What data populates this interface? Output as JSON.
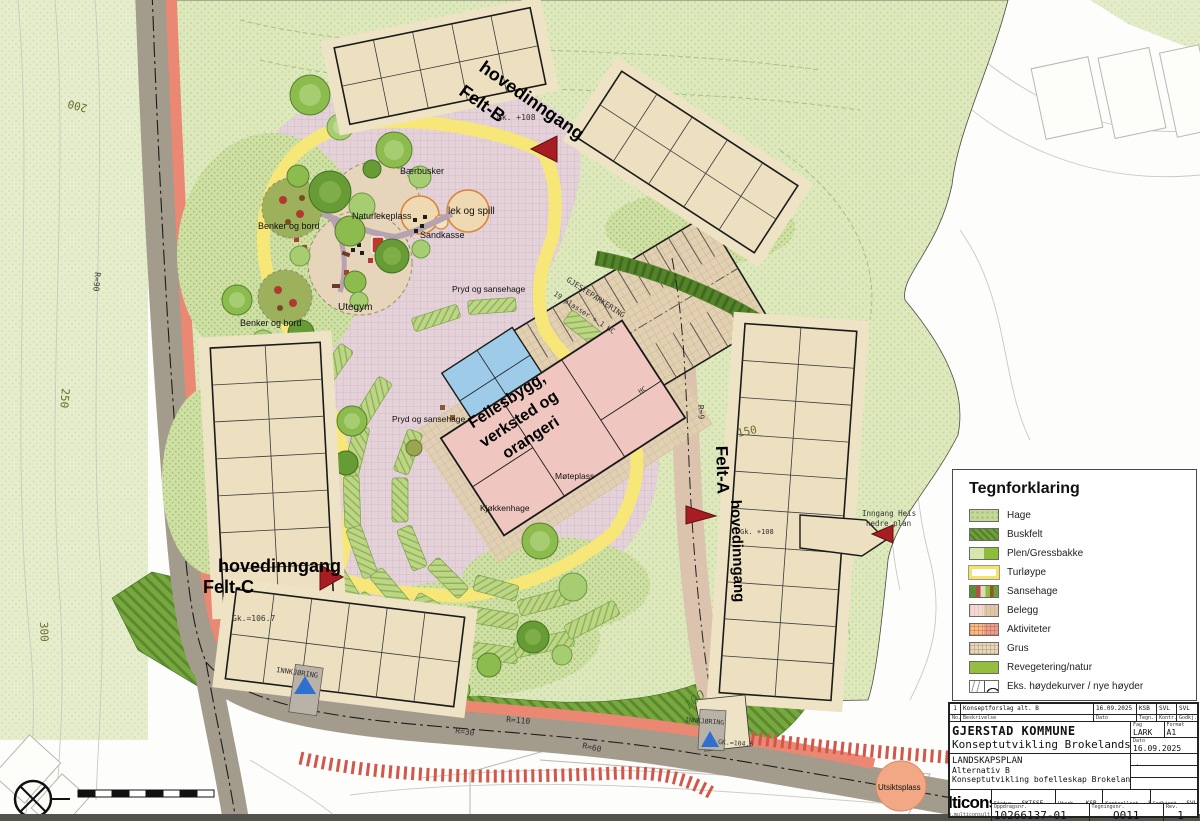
{
  "map": {
    "labels": {
      "feltB_line1": "hovedinngang",
      "feltB_line2": "Felt-B",
      "feltB_gk": "Gk. +108",
      "feltA_line1": "Felt-A",
      "feltA_line2": "hovedinngang",
      "feltA_gk": "Gk. +108",
      "feltC_line1": "hovedinngang",
      "feltC_line2": "Felt-C",
      "feltC_gk": "Gk.=106.7",
      "heis_line1": "Inngang Heis",
      "heis_line2": "nedre plan",
      "fellesbygg_line1": "Fellesbygg,",
      "fellesbygg_line2": "verksted og",
      "fellesbygg_line3": "orangeri",
      "gjesteparkering_line1": "GJESTEPARKERING",
      "gjesteparkering_line2": "19 plasser + 1 HC",
      "innkjoring_c": "INNKJØRING",
      "innkjoring_a": "INNKJØRING",
      "gk_a": "GK.=104.6",
      "baerbusker": "Bærbusker",
      "naturlekeplass": "Naturlekeplass",
      "lek_og_spill": "lek og spill",
      "sandkasse": "Sandkasse",
      "benker1": "Benker og bord",
      "benker2": "Benker og bord",
      "utegym": "Utegym",
      "pryd1": "Pryd og sansehage",
      "pryd2": "Pryd og sansehage",
      "kjokkenhage": "Kjøkkenhage",
      "moteplass": "Møteplass",
      "hc": "HC",
      "utsiktsplass": "Utsiktsplass",
      "c100": "100",
      "c150": "150",
      "c200": "200",
      "c250": "250",
      "c300": "300",
      "r90": "R=90",
      "r30": "R=30",
      "r110": "R=110",
      "r60": "R=60",
      "r9": "R=9"
    }
  },
  "legend": {
    "title": "Tegnforklaring",
    "items": [
      {
        "type": "hage",
        "label": "Hage"
      },
      {
        "type": "buskfelt",
        "label": "Buskfelt"
      },
      {
        "type": "plen",
        "label": "Plen/Gressbakke"
      },
      {
        "type": "turloype",
        "label": "Turløype"
      },
      {
        "type": "sansehage",
        "label": "Sansehage"
      },
      {
        "type": "belegg",
        "label": "Belegg"
      },
      {
        "type": "aktiviteter",
        "label": "Aktiviteter"
      },
      {
        "type": "grus",
        "label": "Grus"
      },
      {
        "type": "reveg",
        "label": "Revegetering/natur"
      },
      {
        "type": "kurver",
        "label": "Eks. høydekurver / nye høyder"
      }
    ]
  },
  "title_block": {
    "rev_no": "1",
    "rev_desc": "Konseptforslag alt. B",
    "rev_date": "16.09.2025",
    "rev_drawn": "KSB",
    "rev_ctrl": "SVL",
    "rev_appr": "SVL",
    "h_no": "No.",
    "h_desc": "Beskrivelse",
    "h_date": "Dato",
    "h_drawn": "Tegn.",
    "h_ctrl": "Kontr.",
    "h_appr": "Godkj.",
    "client": "GJERSTAD KOMMUNE",
    "project": "Konseptutvikling Brokelandsheia",
    "fag_label": "Fag",
    "fag": "LARK",
    "format_label": "Format",
    "format": "A1",
    "dato_label": "Dato",
    "dato": "16.09.2025",
    "sheet1": "LANDSKAPSPLAN",
    "sheet2": "Alternativ B",
    "sheet3": "Konseptutvikling bofelleskap Brokelandsheia",
    "scale_label": "Målestokk",
    "scale": "1:300",
    "coord_label": "Koordinatsystem",
    "coord": "UTM32",
    "datum_label": "Høydedatum",
    "datum": "NN2000",
    "status_label": "Status",
    "status": "SKISSE",
    "drawn_label": "Utarb.",
    "drawn": "KSB",
    "ctrl_label": "Kontrollert",
    "ctrl": "SVL",
    "appr_label": "Godkjent",
    "appr": "SVL",
    "logo": "Multiconsult",
    "logo_url": "www.multiconsult.no",
    "job_label": "Oppdragsnr.",
    "job_no": "10266137-01",
    "dwg_label": "Tegningsnr.",
    "dwg_no": "O011",
    "rev_label": "Rev.",
    "rev": "1"
  }
}
